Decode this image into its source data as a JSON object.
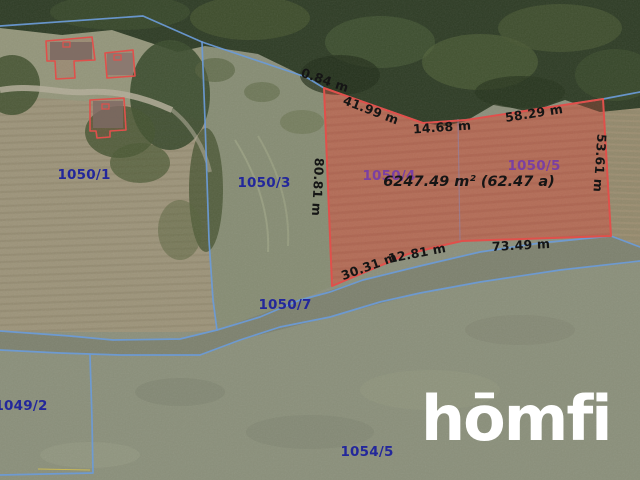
{
  "map_overlay": {
    "watermark": "hōmfi",
    "parcels": [
      {
        "id": "1050/1",
        "x": 84,
        "y": 175,
        "kind": "adjacent"
      },
      {
        "id": "1050/3",
        "x": 264,
        "y": 183,
        "kind": "adjacent"
      },
      {
        "id": "1050/4",
        "x": 389,
        "y": 176,
        "kind": "highlighted"
      },
      {
        "id": "1050/5",
        "x": 534,
        "y": 166,
        "kind": "highlighted"
      },
      {
        "id": "1050/7",
        "x": 285,
        "y": 305,
        "kind": "adjacent"
      },
      {
        "id": "1049/2",
        "x": 21,
        "y": 406,
        "kind": "adjacent"
      },
      {
        "id": "1054/5",
        "x": 367,
        "y": 452,
        "kind": "adjacent"
      }
    ],
    "highlighted_parcel": {
      "area_text": "6247.49 m² (62.47 a)",
      "area_x": 469,
      "area_y": 182,
      "edge_measurements": [
        {
          "text": "0.84 m",
          "x": 325,
          "y": 80,
          "angle": 19
        },
        {
          "text": "41.99 m",
          "x": 371,
          "y": 110,
          "angle": 21
        },
        {
          "text": "14.68 m",
          "x": 442,
          "y": 127,
          "angle": -4
        },
        {
          "text": "58.29 m",
          "x": 534,
          "y": 113,
          "angle": -9
        },
        {
          "text": "80.81 m",
          "x": 318,
          "y": 187,
          "angle": 93
        },
        {
          "text": "53.61 m",
          "x": 600,
          "y": 163,
          "angle": 94
        },
        {
          "text": "30.31 m",
          "x": 369,
          "y": 266,
          "angle": -20
        },
        {
          "text": "12.81 m",
          "x": 417,
          "y": 253,
          "angle": -11
        },
        {
          "text": "73.49 m",
          "x": 521,
          "y": 245,
          "angle": -3
        }
      ]
    },
    "colors": {
      "boundary_blue": "#6b9bd8",
      "parcel_red": "#e0504b",
      "label_navy": "#23279b",
      "label_purple": "#7b3fa2",
      "measurement_black": "#151515",
      "watermark_white": "#ffffff"
    }
  }
}
